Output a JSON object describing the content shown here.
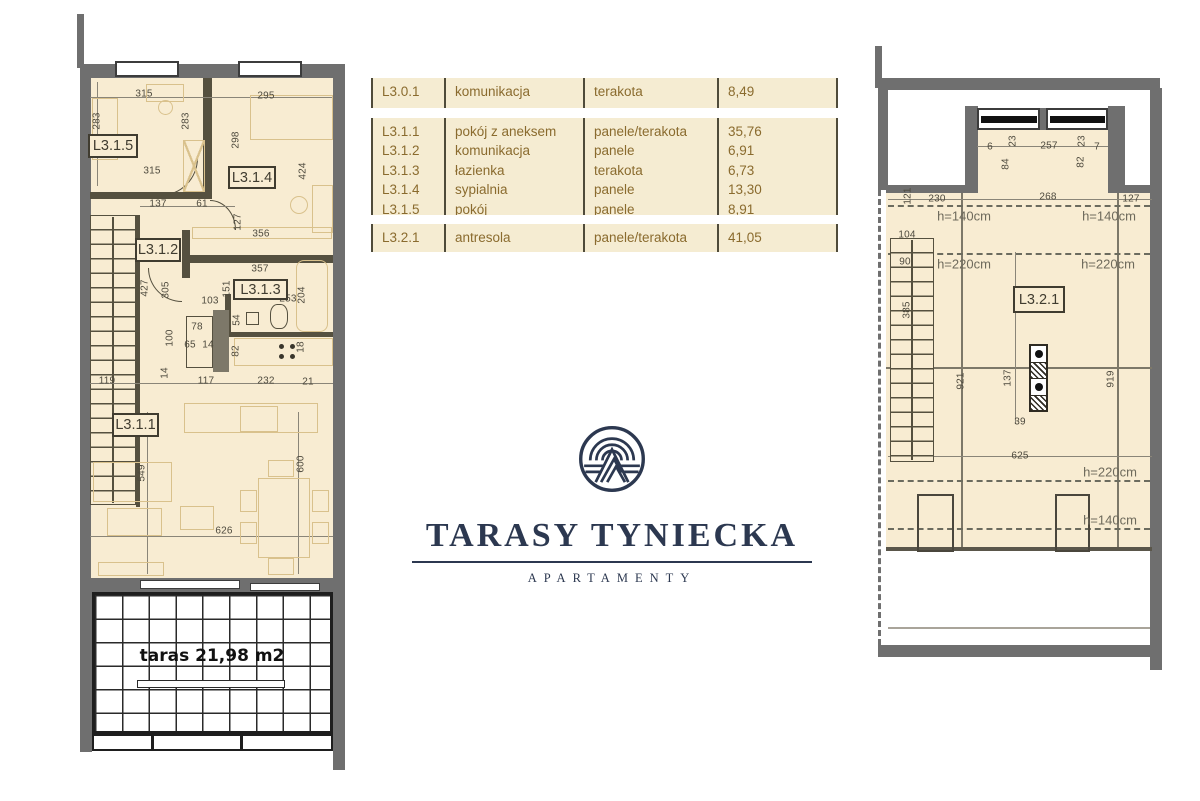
{
  "brand": {
    "title": "TARASY TYNIECKA",
    "subtitle": "APARTAMENTY"
  },
  "colors": {
    "floor": "#f8ecd2",
    "wall": "#6f6f6f",
    "navy": "#2c3850",
    "table_bg": "#f5ecd2",
    "table_text": "#8a6b2e",
    "dim_text": "#4e4a3e"
  },
  "table": {
    "groups": [
      {
        "rows": [
          [
            "L3.0.1",
            "komunikacja",
            "terakota",
            "8,49"
          ]
        ]
      },
      {
        "rows": [
          [
            "L3.1.1",
            "pokój z aneksem",
            "panele/terakota",
            "35,76"
          ],
          [
            "L3.1.2",
            "komunikacja",
            "panele",
            "6,91"
          ],
          [
            "L3.1.3",
            "łazienka",
            "terakota",
            "6,73"
          ],
          [
            "L3.1.4",
            "sypialnia",
            "panele",
            "13,30"
          ],
          [
            "L3.1.5",
            "pokój",
            "panele",
            "8,91"
          ]
        ]
      },
      {
        "rows": [
          [
            "L3.2.1",
            "antresola",
            "panele/terakota",
            "41,05"
          ]
        ]
      }
    ]
  },
  "left_plan": {
    "terrace_label": "taras 21,98 m2",
    "room_labels": [
      {
        "t": "L3.1.5",
        "x": 88,
        "y": 134,
        "w": 50,
        "h": 24
      },
      {
        "t": "L3.1.4",
        "x": 228,
        "y": 166,
        "w": 48,
        "h": 23
      },
      {
        "t": "L3.1.2",
        "x": 135,
        "y": 238,
        "w": 46,
        "h": 24
      },
      {
        "t": "L3.1.3",
        "x": 233,
        "y": 279,
        "w": 55,
        "h": 21
      },
      {
        "t": "L3.1.1",
        "x": 112,
        "y": 413,
        "w": 47,
        "h": 24
      }
    ],
    "dims": [
      {
        "t": "315",
        "x": 144,
        "y": 94
      },
      {
        "t": "295",
        "x": 266,
        "y": 96
      },
      {
        "t": "283",
        "x": 97,
        "y": 121,
        "r": 1
      },
      {
        "t": "283",
        "x": 186,
        "y": 121,
        "r": 1
      },
      {
        "t": "298",
        "x": 236,
        "y": 140,
        "r": 1
      },
      {
        "t": "424",
        "x": 303,
        "y": 171,
        "r": 1
      },
      {
        "t": "315",
        "x": 152,
        "y": 171
      },
      {
        "t": "137",
        "x": 158,
        "y": 204
      },
      {
        "t": "61",
        "x": 202,
        "y": 204
      },
      {
        "t": "127",
        "x": 238,
        "y": 222,
        "r": 1
      },
      {
        "t": "356",
        "x": 261,
        "y": 234
      },
      {
        "t": "427",
        "x": 145,
        "y": 288,
        "r": 1
      },
      {
        "t": "305",
        "x": 166,
        "y": 290,
        "r": 1
      },
      {
        "t": "357",
        "x": 260,
        "y": 269
      },
      {
        "t": "151",
        "x": 227,
        "y": 289,
        "r": 1
      },
      {
        "t": "253",
        "x": 288,
        "y": 299
      },
      {
        "t": "204",
        "x": 302,
        "y": 295,
        "r": 1
      },
      {
        "t": "103",
        "x": 210,
        "y": 301
      },
      {
        "t": "78",
        "x": 197,
        "y": 327
      },
      {
        "t": "65",
        "x": 190,
        "y": 345
      },
      {
        "t": "14",
        "x": 208,
        "y": 345
      },
      {
        "t": "100",
        "x": 170,
        "y": 338,
        "r": 1
      },
      {
        "t": "54",
        "x": 237,
        "y": 320,
        "r": 1
      },
      {
        "t": "82",
        "x": 236,
        "y": 351,
        "r": 1
      },
      {
        "t": "18",
        "x": 301,
        "y": 347,
        "r": 1
      },
      {
        "t": "14",
        "x": 165,
        "y": 373,
        "r": 1
      },
      {
        "t": "119",
        "x": 107,
        "y": 381
      },
      {
        "t": "117",
        "x": 206,
        "y": 381
      },
      {
        "t": "232",
        "x": 266,
        "y": 381
      },
      {
        "t": "21",
        "x": 308,
        "y": 382
      },
      {
        "t": "549",
        "x": 142,
        "y": 473,
        "r": 1
      },
      {
        "t": "600",
        "x": 301,
        "y": 464,
        "r": 1
      },
      {
        "t": "626",
        "x": 224,
        "y": 531
      }
    ]
  },
  "right_plan": {
    "room_labels": [
      {
        "t": "L3.2.1",
        "x": 1013,
        "y": 286,
        "w": 52,
        "h": 27
      }
    ],
    "dims": [
      {
        "t": "6",
        "x": 990,
        "y": 147
      },
      {
        "t": "23",
        "x": 1013,
        "y": 141,
        "r": 1
      },
      {
        "t": "257",
        "x": 1049,
        "y": 146
      },
      {
        "t": "23",
        "x": 1082,
        "y": 141,
        "r": 1
      },
      {
        "t": "7",
        "x": 1097,
        "y": 147
      },
      {
        "t": "84",
        "x": 1006,
        "y": 164,
        "r": 1
      },
      {
        "t": "82",
        "x": 1081,
        "y": 162,
        "r": 1
      },
      {
        "t": "121",
        "x": 908,
        "y": 196,
        "r": 1
      },
      {
        "t": "230",
        "x": 937,
        "y": 199
      },
      {
        "t": "268",
        "x": 1048,
        "y": 197
      },
      {
        "t": "127",
        "x": 1131,
        "y": 199
      },
      {
        "t": "104",
        "x": 907,
        "y": 235
      },
      {
        "t": "90",
        "x": 905,
        "y": 262
      },
      {
        "t": "385",
        "x": 907,
        "y": 310,
        "r": 1
      },
      {
        "t": "921",
        "x": 961,
        "y": 381,
        "r": 1
      },
      {
        "t": "137",
        "x": 1008,
        "y": 378,
        "r": 1
      },
      {
        "t": "919",
        "x": 1111,
        "y": 379,
        "r": 1
      },
      {
        "t": "39",
        "x": 1020,
        "y": 422
      },
      {
        "t": "625",
        "x": 1020,
        "y": 456
      }
    ],
    "heights": [
      {
        "t": "h=140cm",
        "x": 964,
        "y": 216
      },
      {
        "t": "h=140cm",
        "x": 1109,
        "y": 216
      },
      {
        "t": "h=220cm",
        "x": 964,
        "y": 264
      },
      {
        "t": "h=220cm",
        "x": 1108,
        "y": 264
      },
      {
        "t": "h=220cm",
        "x": 1110,
        "y": 472
      },
      {
        "t": "h=140cm",
        "x": 1110,
        "y": 520
      }
    ]
  }
}
